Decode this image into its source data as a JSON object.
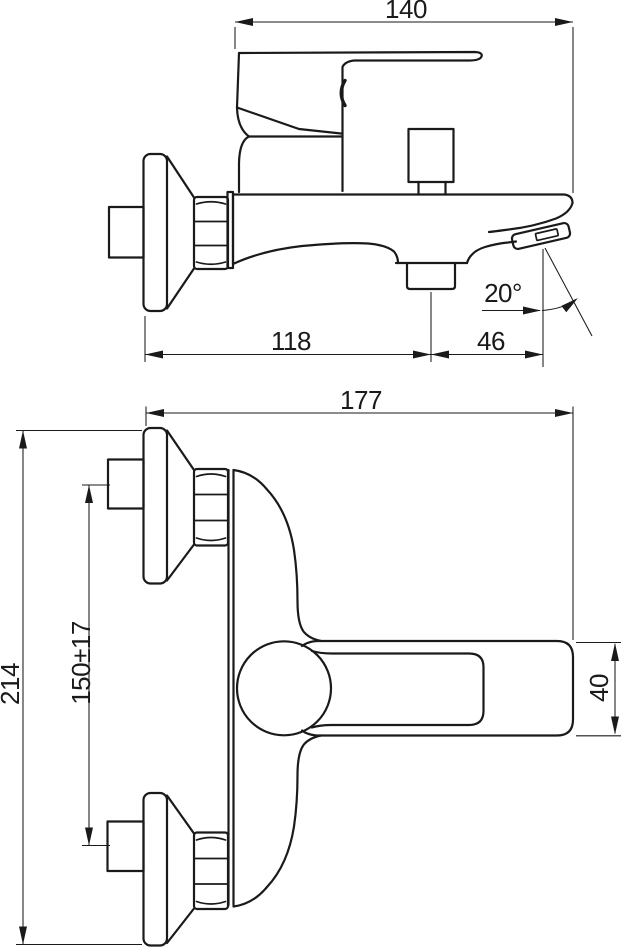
{
  "drawing": {
    "side_view": {
      "overall_depth": "140",
      "wall_to_outlet": "118",
      "outlet_to_spout_tip": "46",
      "spout_angle": "20°"
    },
    "front_view": {
      "overall_width": "177",
      "overall_height": "214",
      "connection_spacing": "150±17",
      "spout_width": "40"
    }
  }
}
